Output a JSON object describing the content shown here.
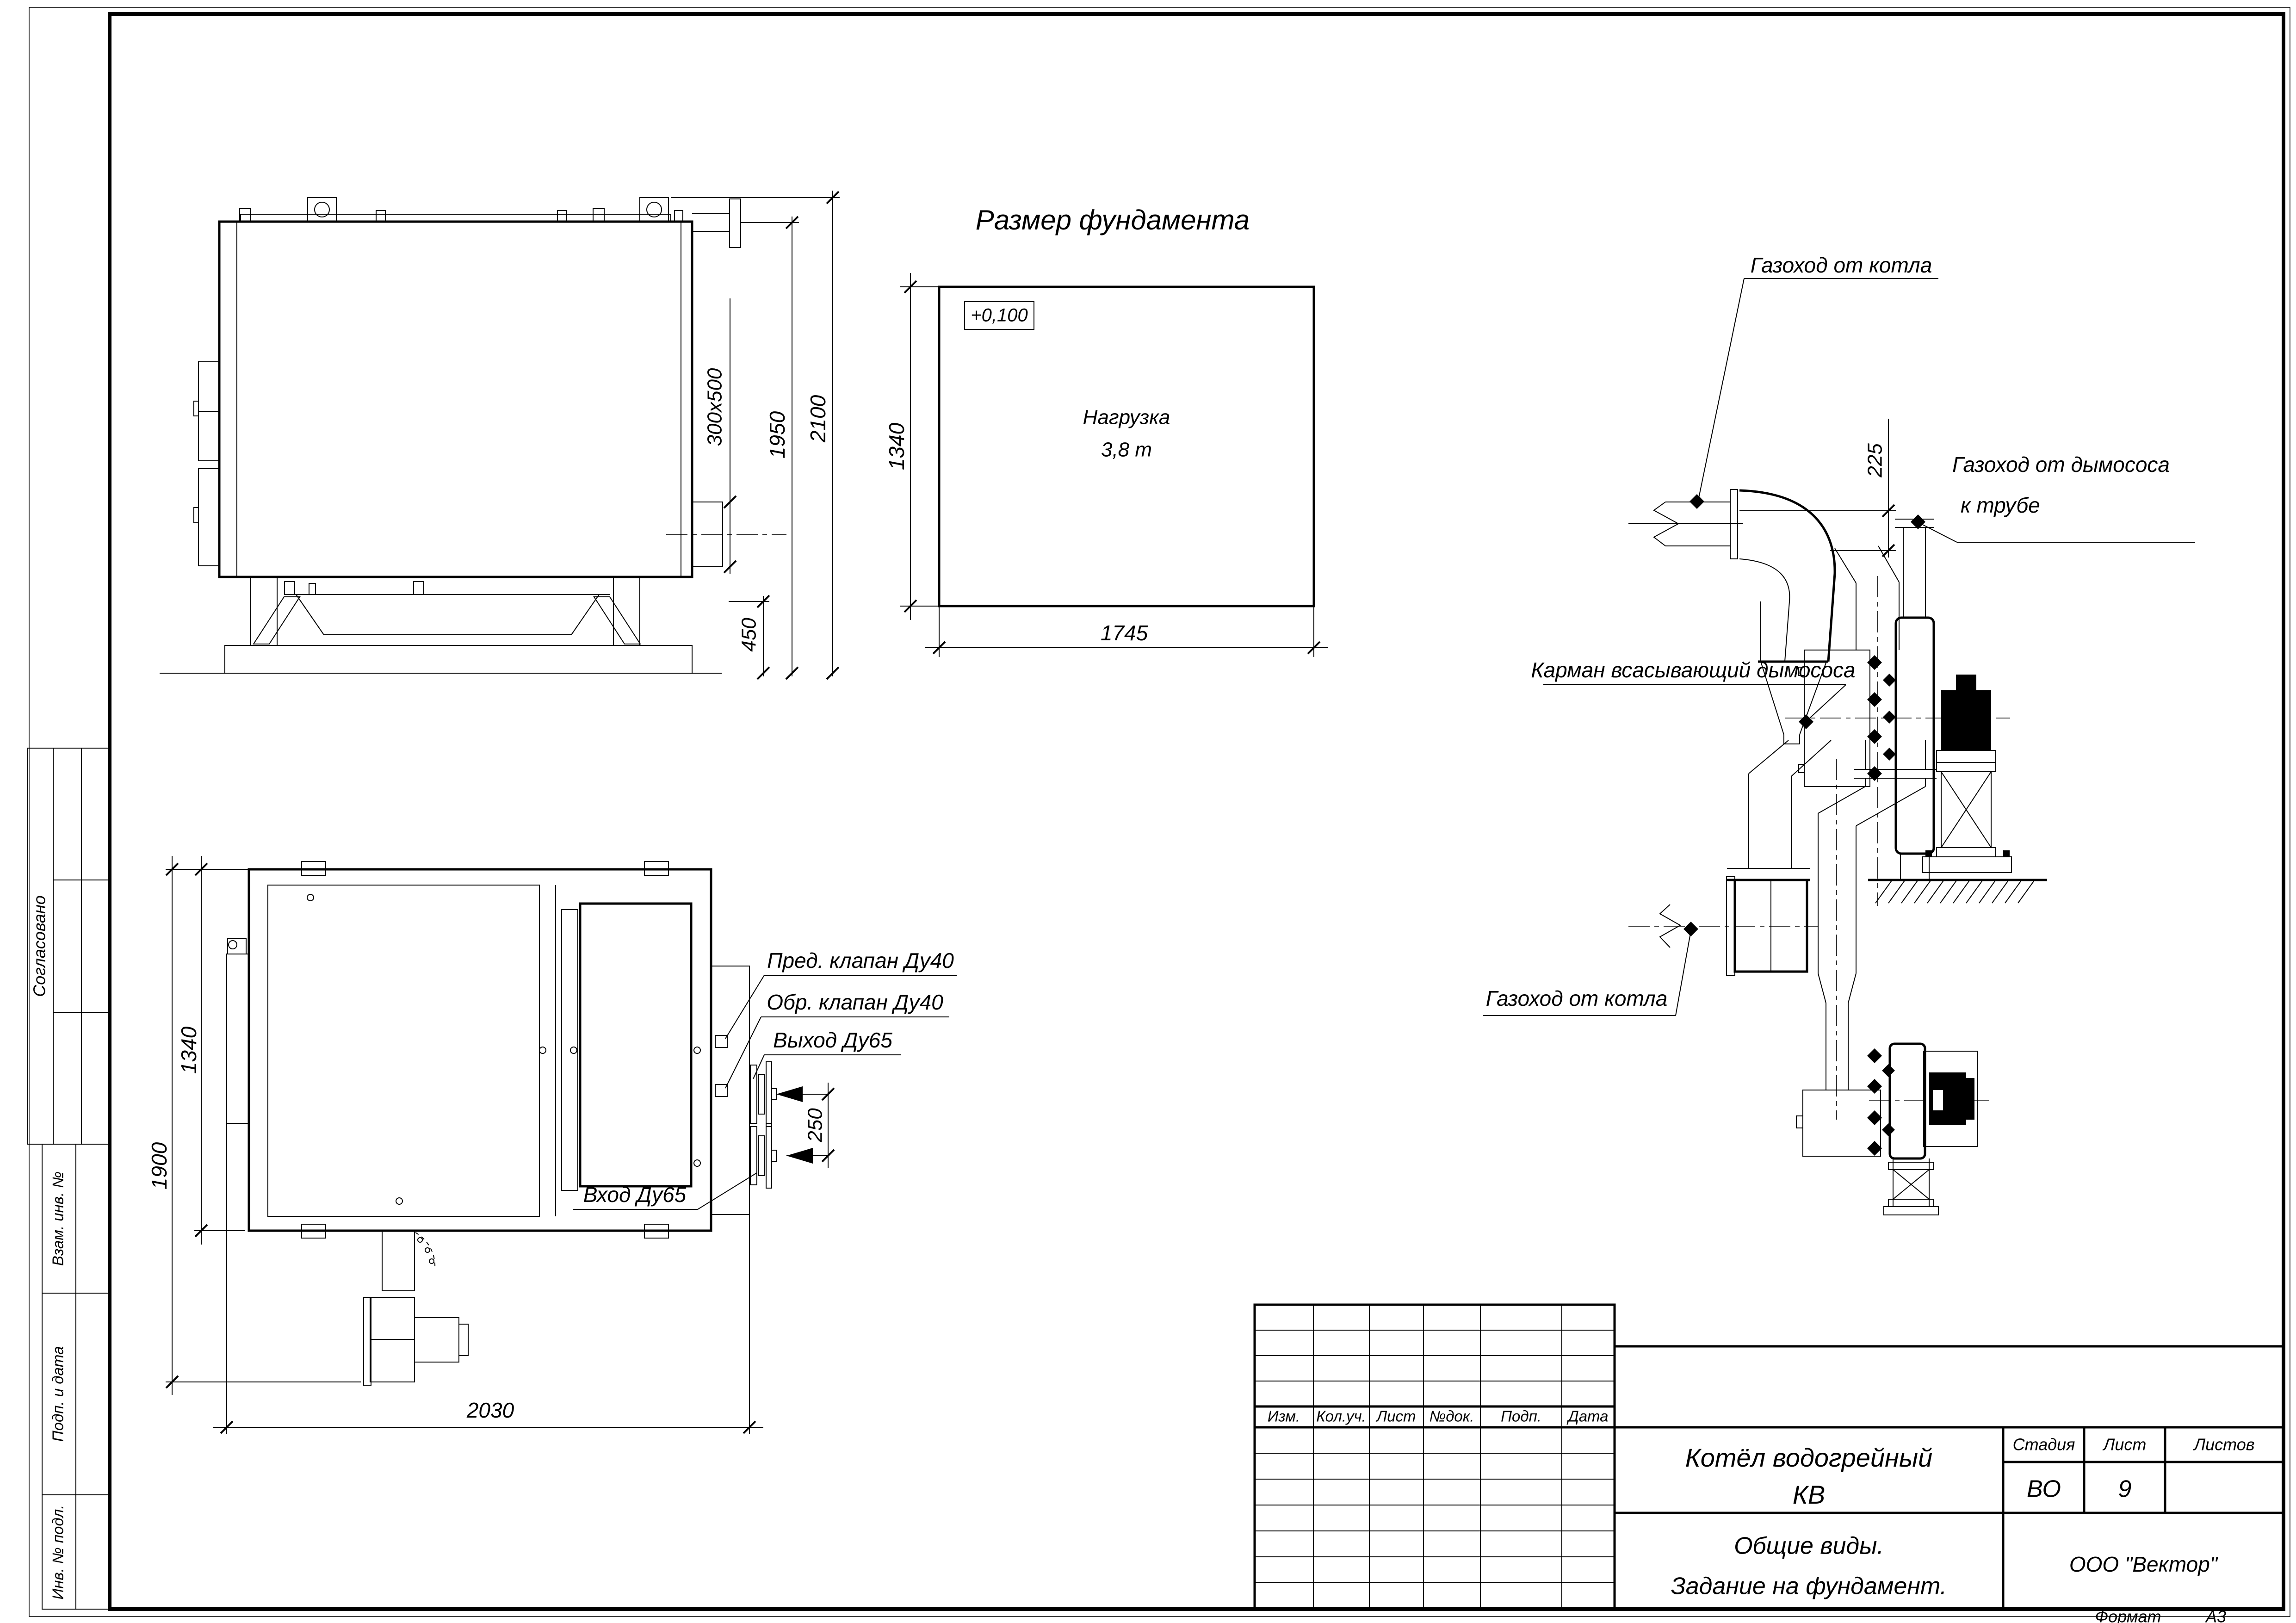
{
  "sheet": {
    "format_label": "Формат",
    "format_value": "А3"
  },
  "title_block": {
    "doc_title_line1": "Котёл водогрейный",
    "doc_title_line2": "КВ",
    "subtitle_line1": "Общие виды.",
    "subtitle_line2": "Задание на фундамент.",
    "company": "ООО \"Вектор\"",
    "stage_header": "Стадия",
    "sheet_header": "Лист",
    "sheets_header": "Листов",
    "stage_value": "ВО",
    "sheet_value": "9",
    "sheets_value": "",
    "columns": [
      "Изм.",
      "Кол.уч.",
      "Лист",
      "№док.",
      "Подп.",
      "Дата"
    ]
  },
  "sidebar": {
    "approved": "Согласовано",
    "replace_inv": "Взам. инв. №",
    "sign_date": "Подп. и дата",
    "inv_orig": "Инв. № подл."
  },
  "foundation": {
    "title": "Размер фундамента",
    "elevation": "+0,100",
    "load_line1": "Нагрузка",
    "load_line2": "3,8 т",
    "width_dim": "1745",
    "height_dim": "1340"
  },
  "side_view": {
    "dim_total_height": "2100",
    "dim_flange_height": "1950",
    "dim_hatch": "300x500",
    "dim_base": "450"
  },
  "plan_view": {
    "dim_width": "2030",
    "dim_depth_total": "1900",
    "dim_depth_inner": "1340",
    "dim_nozzle_spacing": "250",
    "label_safety_valve": "Пред. клапан Ду40",
    "label_check_valve": "Обр. клапан Ду40",
    "label_outlet": "Выход Ду65",
    "label_inlet": "Вход Ду65"
  },
  "duct_side_view": {
    "label_from_boiler": "Газоход от котла",
    "label_to_stack_line1": "Газоход от дымососа",
    "label_to_stack_line2": "к трубе",
    "label_suction_pocket": "Карман всасывающий дымососа",
    "dim_offset": "225"
  },
  "duct_plan_view": {
    "label_from_boiler": "Газоход от котла"
  }
}
